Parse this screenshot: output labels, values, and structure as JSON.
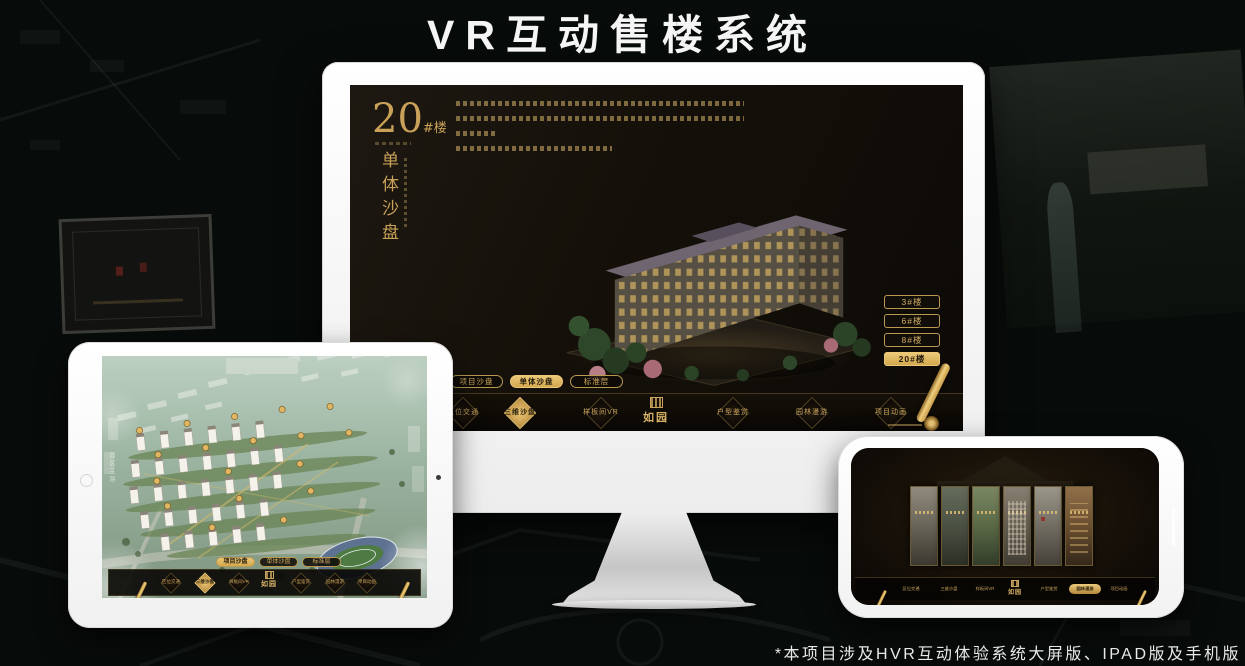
{
  "page": {
    "title": "VR互动售楼系统",
    "footnote": "*本项目涉及HVR互动体验系统大屏版、IPAD版及手机版"
  },
  "colors": {
    "accent_gold": "#c9a158",
    "selected_gold": "#e2b763",
    "screen_background": "#13100b"
  },
  "icons": {
    "scroll_quill": "scroll-quill-icon",
    "logo_seal": "seal-icon"
  },
  "monitor": {
    "screen_title": {
      "number": "20",
      "suffix": "#楼",
      "subtitle": "单体沙盘"
    },
    "floor_buttons": [
      {
        "label": "3#楼",
        "selected": false
      },
      {
        "label": "6#楼",
        "selected": false
      },
      {
        "label": "8#楼",
        "selected": false
      },
      {
        "label": "20#楼",
        "selected": true
      }
    ],
    "view_tabs": [
      {
        "label": "项目沙盘",
        "selected": false
      },
      {
        "label": "单体沙盘",
        "selected": true
      },
      {
        "label": "标准层",
        "selected": false
      }
    ],
    "nav": {
      "logo": "如园",
      "items": [
        {
          "label": "区位交通",
          "selected": false
        },
        {
          "label": "三维沙盘",
          "selected": true
        },
        {
          "label": "样板间VR",
          "selected": false
        },
        {
          "label": "户型鉴赏",
          "selected": false
        },
        {
          "label": "园林漫游",
          "selected": false
        },
        {
          "label": "项目动画",
          "selected": false
        }
      ]
    }
  },
  "tablet": {
    "road_label": "园区三路",
    "view_tabs": [
      {
        "label": "项目沙盘",
        "selected": true
      },
      {
        "label": "单体沙盘",
        "selected": false
      },
      {
        "label": "标准层",
        "selected": false
      }
    ],
    "nav": {
      "logo": "如园",
      "items": [
        {
          "label": "区位交通",
          "selected": false
        },
        {
          "label": "三维沙盘",
          "selected": true
        },
        {
          "label": "样板间VR",
          "selected": false
        },
        {
          "label": "户型鉴赏",
          "selected": false
        },
        {
          "label": "园林漫游",
          "selected": false
        },
        {
          "label": "项目动画",
          "selected": false
        }
      ]
    }
  },
  "phone": {
    "nav": {
      "logo": "如园",
      "items": [
        {
          "label": "区位交通",
          "selected": false
        },
        {
          "label": "三维沙盘",
          "selected": false
        },
        {
          "label": "样板间VR",
          "selected": false
        },
        {
          "label": "户型鉴赏",
          "selected": false
        },
        {
          "label": "园林漫游",
          "selected": true
        },
        {
          "label": "项目动画",
          "selected": false
        }
      ]
    }
  }
}
